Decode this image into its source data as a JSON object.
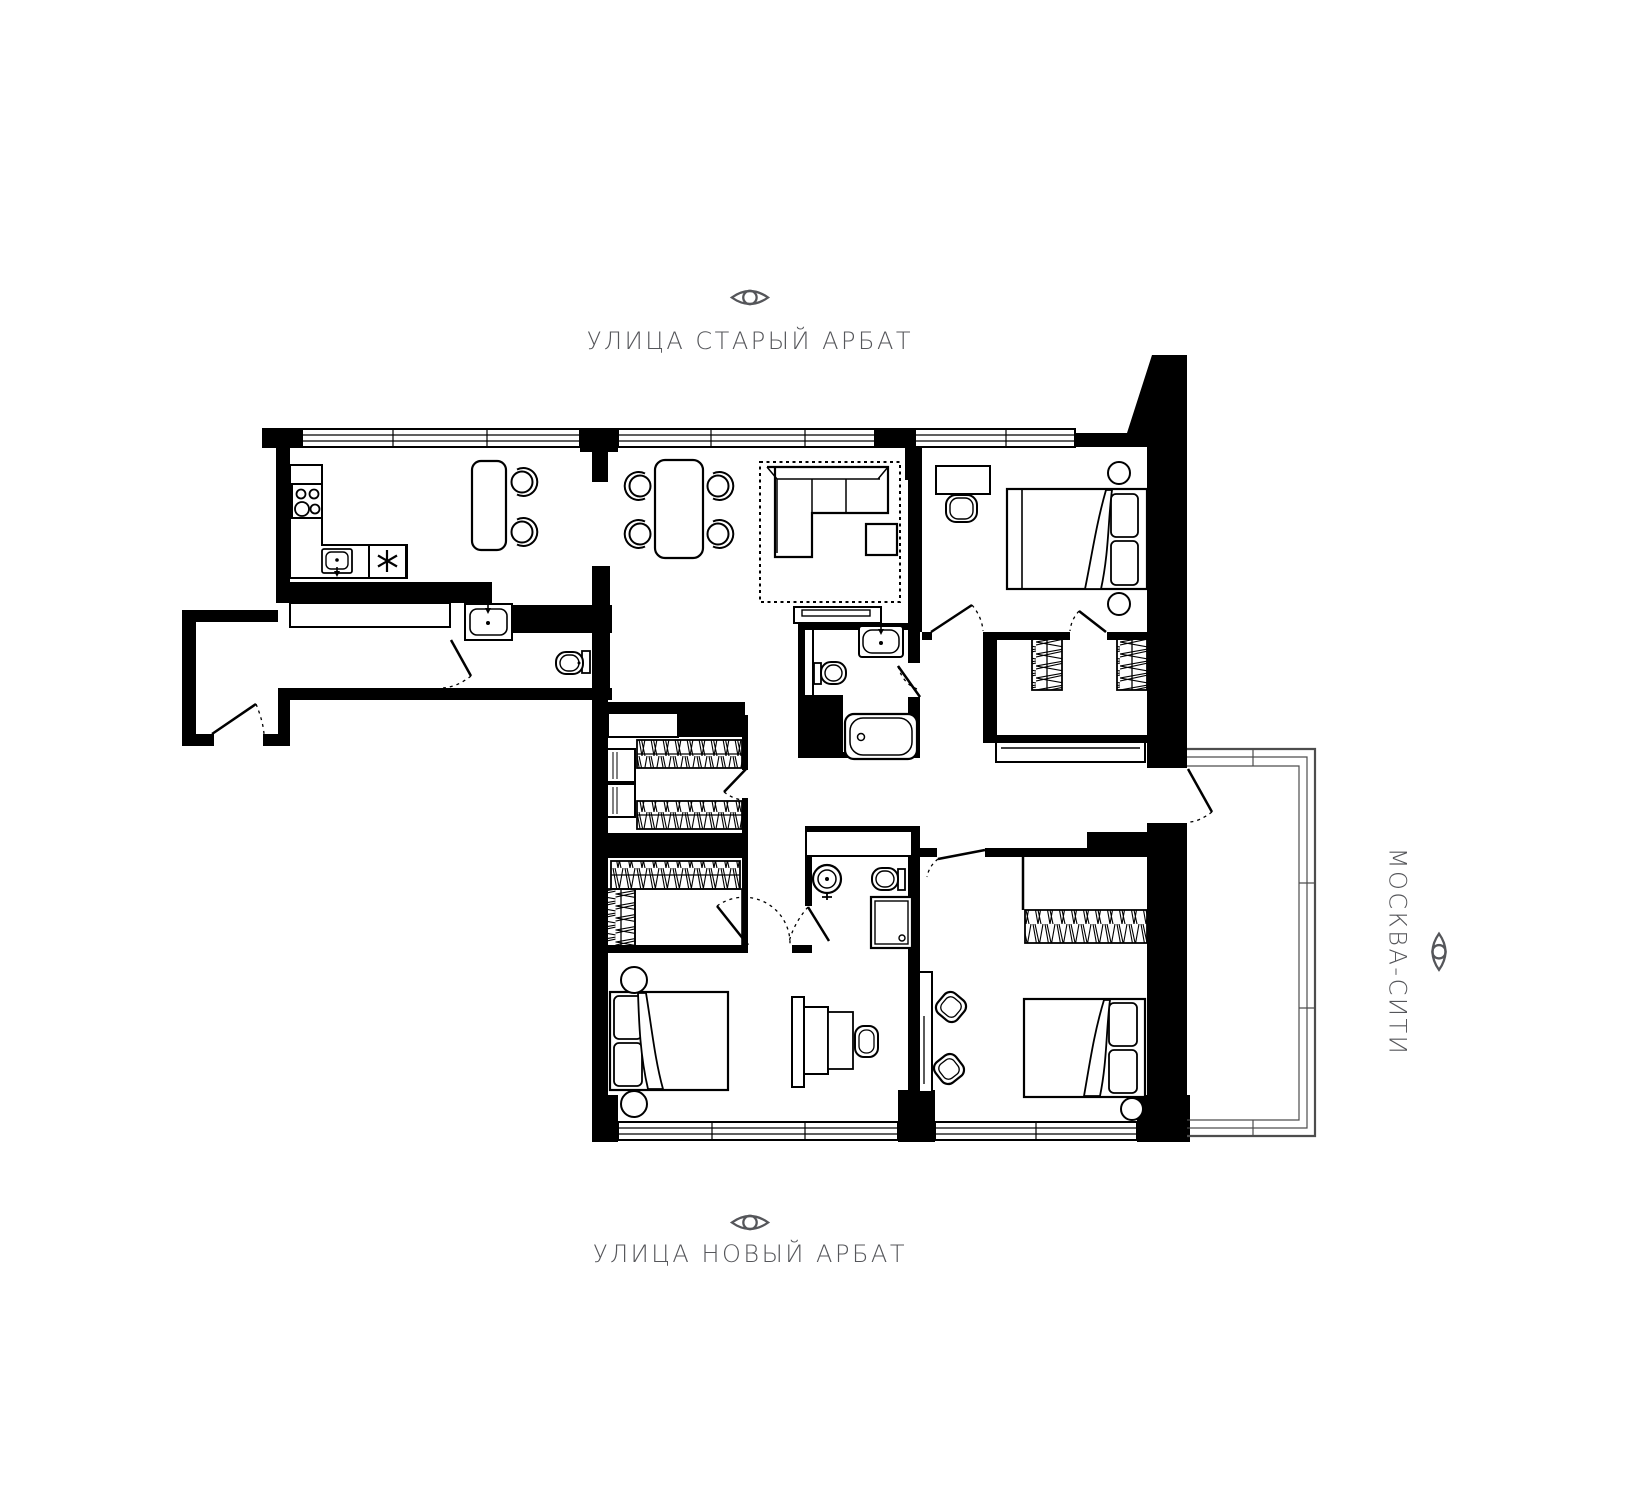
{
  "page": {
    "background": "#ffffff",
    "plan_ink": "#000000",
    "label_color": "#55565a"
  },
  "labels": {
    "top": {
      "text": "УЛИЦА СТАРЫЙ АРБАТ",
      "icon": "eye-icon"
    },
    "bottom": {
      "text": "УЛИЦА НОВЫЙ АРБАТ",
      "icon": "eye-icon"
    },
    "right": {
      "text": "МОСКВА-СИТИ",
      "icon": "eye-icon"
    }
  }
}
